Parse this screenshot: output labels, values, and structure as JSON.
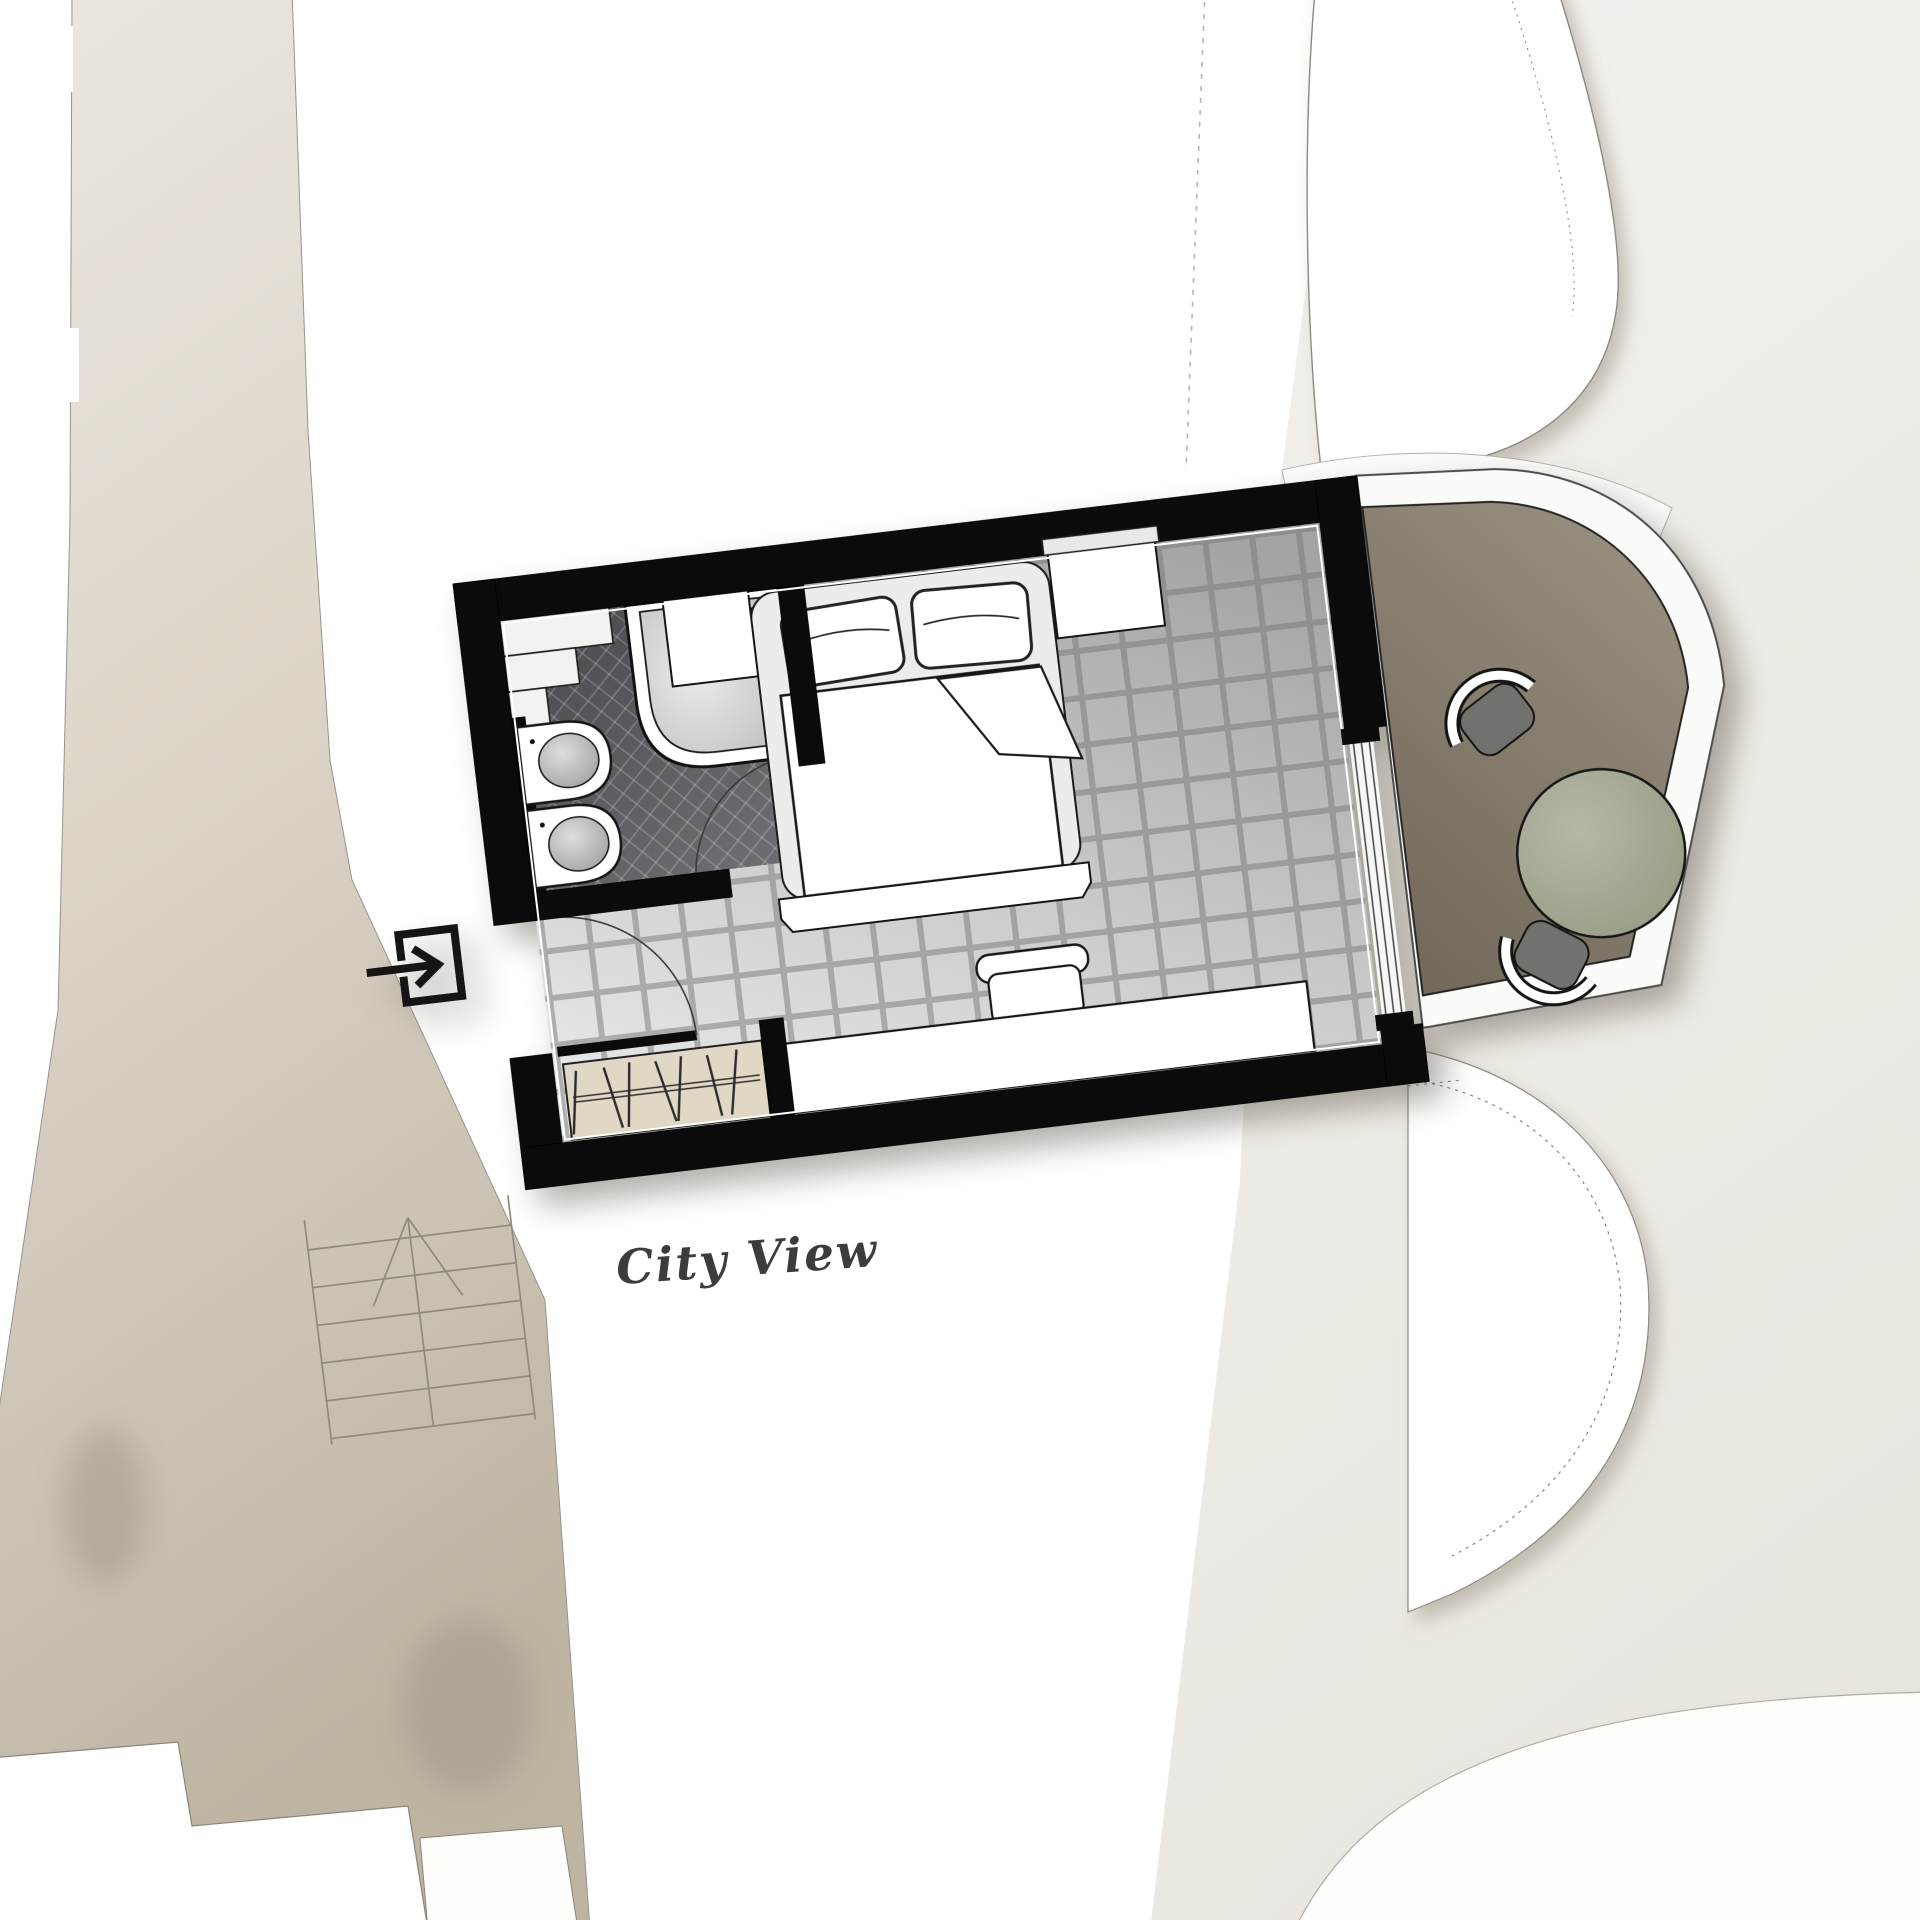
{
  "annotation": {
    "city_view_label": "City View"
  },
  "icons": {
    "entry": "entry-arrow-icon",
    "stairs": "stairs-symbol",
    "door_swing": "door-swing-arc"
  },
  "palette": {
    "wall": "#0b0b0b",
    "ink": "#161616",
    "ink_text": "#3c3c3c",
    "floor_dark": "#a6a6a8",
    "floor_light": "#e7e7e7",
    "bathroom_floor": "#55555a",
    "balcony_floor": "#857b6b",
    "railing": "#fbfbfa",
    "corridor": "#d9d2c3",
    "ground": "#f0ede8",
    "table": "#a9ad9b",
    "chair_seat": "#71716d"
  },
  "plan": {
    "rotation_deg": -6.84,
    "view_label_target": "city",
    "rooms": [
      {
        "name": "bathroom"
      },
      {
        "name": "bedroom"
      },
      {
        "name": "balcony"
      },
      {
        "name": "corridor"
      }
    ],
    "furniture": [
      {
        "name": "shower"
      },
      {
        "name": "sink",
        "count": 2
      },
      {
        "name": "double-bed",
        "pillows": 2
      },
      {
        "name": "nightstand",
        "count": 2
      },
      {
        "name": "desk-sideboard"
      },
      {
        "name": "desk-chair"
      },
      {
        "name": "wardrobe",
        "hangers": 7
      },
      {
        "name": "round-table"
      },
      {
        "name": "balcony-chair",
        "count": 2
      }
    ]
  }
}
